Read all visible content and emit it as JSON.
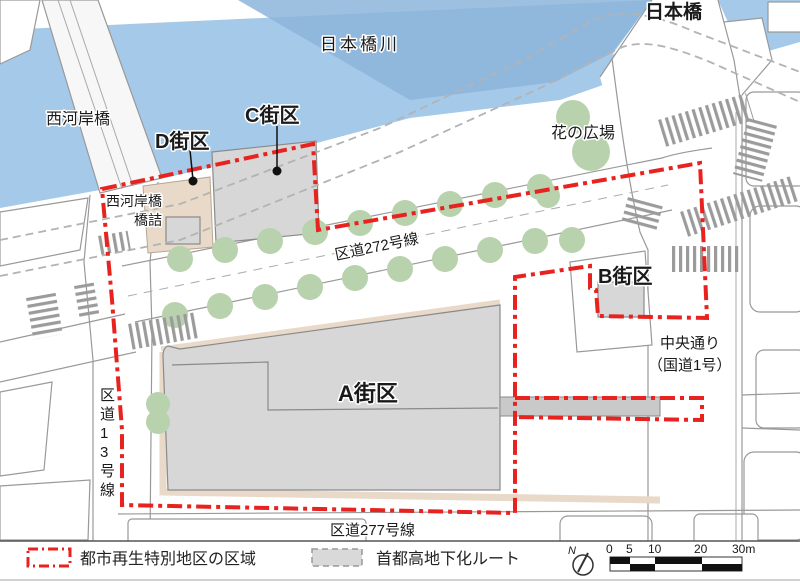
{
  "map": {
    "labels": {
      "river": "日本橋川",
      "nihonbashi_bridge": "日本橋",
      "nishikashi_bridge": "西河岸橋",
      "hashizume_line1": "西河岸橋",
      "hashizume_line2": "橋詰",
      "block_a": "A街区",
      "block_b": "B街区",
      "block_c": "C街区",
      "block_d": "D街区",
      "hana_plaza": "花の広場",
      "road_272": "区道272号線",
      "road_13": "区道13号線",
      "road_277": "区道277号線",
      "chuo_dori": "中央通り",
      "chuo_dori_sub": "（国道1号）"
    },
    "colors": {
      "water": "#a5c9e8",
      "water_dark": "#8cb5da",
      "building_gray": "#d7d7d7",
      "tree_green": "#b8d2ad",
      "district_red": "#e8231f",
      "route_gray": "#b3b3b3",
      "land_tan": "#e9d9c8"
    }
  },
  "legend": {
    "district_label": "都市再生特別地区の区域",
    "route_label": "首都高地下化ルート",
    "north_label": "N",
    "scale": {
      "ticks": [
        "0",
        "5",
        "10",
        "20",
        "30m"
      ]
    }
  }
}
